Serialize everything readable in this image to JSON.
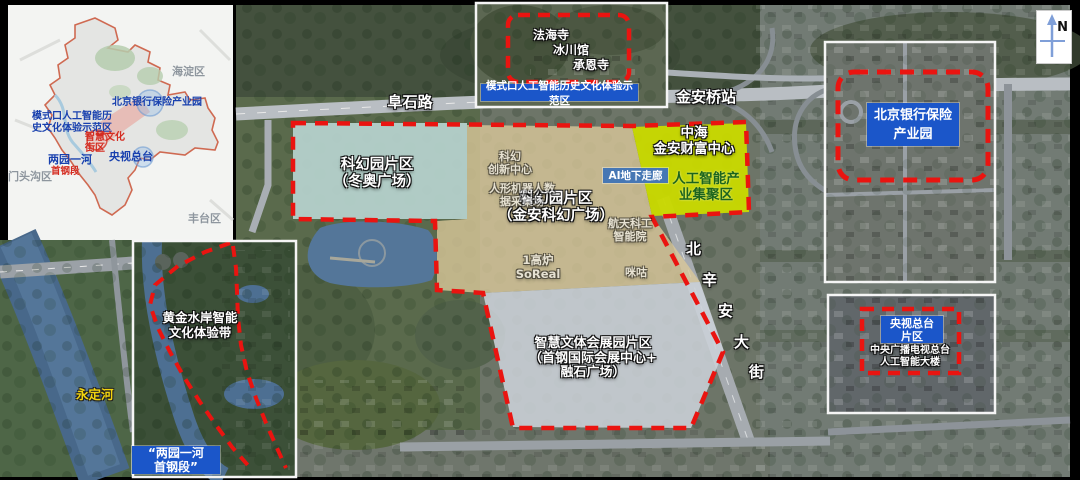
{
  "colors": {
    "boundary_red": "#ea1410",
    "label_blue": "#1b56c9",
    "corridor_blue": "#4677b4",
    "zone_teal": "#b7d3cf",
    "zone_tan": "#d9c89a",
    "zone_gray": "#ccd1d8",
    "zone_yellow_green": "#c9d800",
    "river_name_yellow": "#f2d40e"
  },
  "district_inset": {
    "haidian": "海淀区",
    "mentougou": "门头沟区",
    "fengtai": "丰台区",
    "bank_park": "北京银行保险产业园",
    "moshikou_l1": "模式口人工智能历",
    "moshikou_l2": "史文化体验示范区",
    "culture_l1": "智慧文化",
    "culture_l2": "街区",
    "cctv": "央视总台",
    "liangyuan": "两园一河",
    "shougang": "首钢段"
  },
  "moshikou_inset": {
    "fahai_temple": "法海寺",
    "glacier_hall": "冰川馆",
    "chengen_temple": "承恩寺",
    "banner": "模式口人工智能历史文化体验示范区"
  },
  "bank_inset": {
    "l1": "北京银行保险",
    "l2": "产业园"
  },
  "cctv_inset": {
    "l1": "央视总台",
    "l2": "片区",
    "sub_l1": "中央广播电视总台",
    "sub_l2": "人工智能大楼"
  },
  "west_strip": {
    "river": "永定河",
    "belt_l1": "黄金水岸智能",
    "belt_l2": "文化体验带",
    "seg_l1": "“两园一河",
    "seg_l2": "首钢段”"
  },
  "main_map": {
    "fushi_road": "阜石路",
    "jinanqiao_station": "金安桥站",
    "beixinan_chars": [
      "北",
      "辛",
      "安",
      "大",
      "街"
    ],
    "zone_winter_l1": "科幻园片区",
    "zone_winter_l2": "（冬奥广场）",
    "zone_scifi_l1": "科幻园片区",
    "zone_scifi_l2": "（金安科幻广场）",
    "zone_expo_l1": "智慧文体会展园片区",
    "zone_expo_l2": "（首钢国际会展中心+",
    "zone_expo_l3": "融石广场）",
    "zhonghai_l1": "中海",
    "zhonghai_l2": "金安财富中心",
    "ai_cluster_l1": "人工智能产",
    "ai_cluster_l2": "业集聚区",
    "ai_corridor": "AI地下走廊",
    "poi_scifi_l1": "科幻",
    "poi_scifi_l2": "创新中心",
    "poi_robot_l1": "人形机器人数",
    "poi_robot_l2": "据采集场",
    "poi_aero_l1": "航天科工",
    "poi_aero_l2": "智能院",
    "poi_furnace_l1": "1高炉",
    "poi_furnace_l2": "SoReal",
    "poi_migu": "咪咕"
  },
  "compass": {
    "n": "N"
  }
}
